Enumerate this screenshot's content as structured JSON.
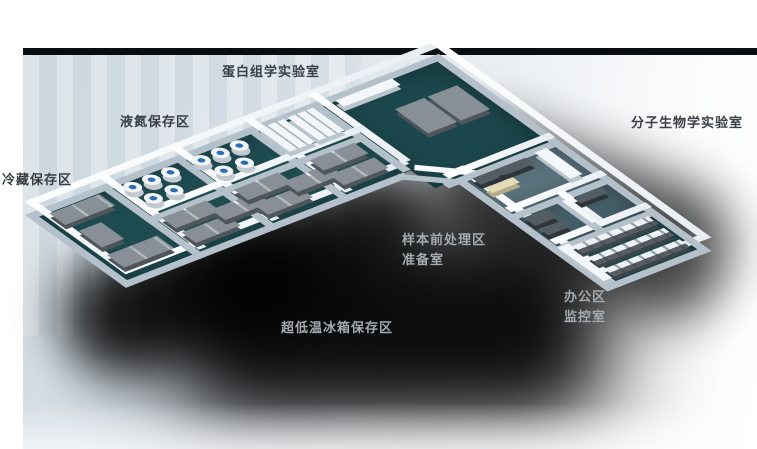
{
  "labels": [
    {
      "id": "proteomics-lab",
      "text": "蛋白组学实验室"
    },
    {
      "id": "liquid-nitrogen-storage",
      "text": "液氮保存区"
    },
    {
      "id": "cold-storage",
      "text": "冷藏保存区"
    },
    {
      "id": "molecular-biology-lab",
      "text": "分子生物学实验室"
    },
    {
      "id": "sample-pretreatment-area",
      "text": "样本前处理区"
    },
    {
      "id": "prep-room",
      "text": "准备室"
    },
    {
      "id": "ult-freezer-storage",
      "text": "超低温冰箱保存区"
    },
    {
      "id": "office-area",
      "text": "办公区"
    },
    {
      "id": "monitoring-room",
      "text": "监控室"
    }
  ],
  "colors": {
    "floor_teal": "#1e4b50",
    "wall_white": "#f3f7fa",
    "equipment_gray": "#888f96",
    "dewar_cap_blue": "#2f6db2",
    "office_floor": "#47626c",
    "backdrop_blue_gray": "#d2dce3",
    "backdrop_top_edge": "#0b0e10",
    "shadow": "#000000",
    "label_dark": "#3a4045",
    "label_light": "#a4abb0"
  }
}
